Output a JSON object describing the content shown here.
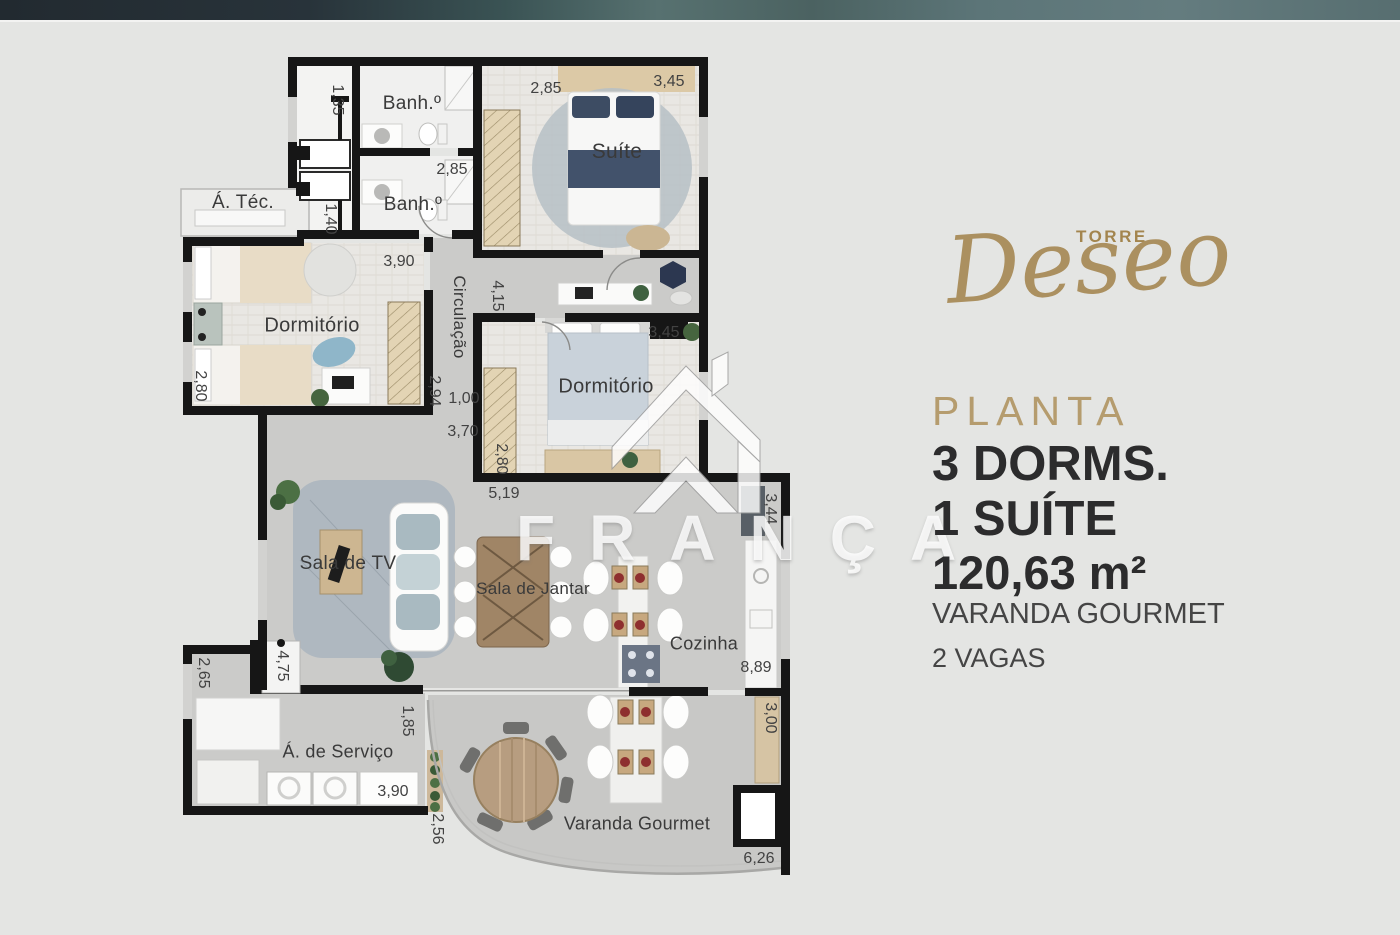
{
  "watermark": {
    "text": "FRANÇA",
    "logo": "house-arrow-icon"
  },
  "info": {
    "tower_label": "TORRE",
    "tower_name": "Deseo",
    "section_label": "PLANTA",
    "dorms": "3 DORMS.",
    "suite": "1 SUÍTE",
    "area": "120,63 m²",
    "feature_1": "VARANDA GOURMET",
    "feature_2": "2 VAGAS",
    "accent_color": "#a98e5c",
    "text_color": "#2c2c2d"
  },
  "plan": {
    "room_labels": [
      {
        "text": "Banh.º",
        "x": 412,
        "y": 104,
        "rot": false,
        "size": 19
      },
      {
        "text": "Suíte",
        "x": 617,
        "y": 152,
        "rot": false,
        "size": 21
      },
      {
        "text": "Banh.º",
        "x": 413,
        "y": 205,
        "rot": false,
        "size": 19
      },
      {
        "text": "Á. Téc.",
        "x": 243,
        "y": 203,
        "rot": false,
        "size": 19
      },
      {
        "text": "Circulação",
        "x": 459,
        "y": 317,
        "rot": true,
        "size": 17
      },
      {
        "text": "Dormitório",
        "x": 312,
        "y": 326,
        "rot": false,
        "size": 20
      },
      {
        "text": "Dormitório",
        "x": 606,
        "y": 387,
        "rot": false,
        "size": 20
      },
      {
        "text": "Sala de TV",
        "x": 348,
        "y": 564,
        "rot": false,
        "size": 19
      },
      {
        "text": "Sala de Jantar",
        "x": 533,
        "y": 589,
        "rot": false,
        "size": 17
      },
      {
        "text": "Cozinha",
        "x": 704,
        "y": 644,
        "rot": false,
        "size": 18
      },
      {
        "text": "Á. de Serviço",
        "x": 338,
        "y": 752,
        "rot": false,
        "size": 18
      },
      {
        "text": "Varanda Gourmet",
        "x": 637,
        "y": 824,
        "rot": false,
        "size": 18
      }
    ],
    "dim_labels": [
      {
        "text": "1,35",
        "x": 337,
        "y": 100,
        "rot": true
      },
      {
        "text": "2,85",
        "x": 546,
        "y": 89,
        "rot": false
      },
      {
        "text": "3,45",
        "x": 669,
        "y": 82,
        "rot": false
      },
      {
        "text": "2,85",
        "x": 452,
        "y": 170,
        "rot": false
      },
      {
        "text": "1,40",
        "x": 330,
        "y": 219,
        "rot": true
      },
      {
        "text": "3,90",
        "x": 399,
        "y": 262,
        "rot": false
      },
      {
        "text": "4,15",
        "x": 497,
        "y": 296,
        "rot": true
      },
      {
        "text": "3,45",
        "x": 664,
        "y": 333,
        "rot": false
      },
      {
        "text": "2,80",
        "x": 200,
        "y": 386,
        "rot": true
      },
      {
        "text": "2,94",
        "x": 434,
        "y": 391,
        "rot": true
      },
      {
        "text": "1,00",
        "x": 464,
        "y": 399,
        "rot": false
      },
      {
        "text": "3,70",
        "x": 463,
        "y": 432,
        "rot": false
      },
      {
        "text": "2,80",
        "x": 501,
        "y": 459,
        "rot": true
      },
      {
        "text": "5,19",
        "x": 504,
        "y": 494,
        "rot": false
      },
      {
        "text": "3,44",
        "x": 770,
        "y": 509,
        "rot": true
      },
      {
        "text": "8,89",
        "x": 756,
        "y": 668,
        "rot": false
      },
      {
        "text": "4,75",
        "x": 282,
        "y": 666,
        "rot": true
      },
      {
        "text": "2,65",
        "x": 203,
        "y": 673,
        "rot": true
      },
      {
        "text": "1,85",
        "x": 407,
        "y": 721,
        "rot": true
      },
      {
        "text": "3,00",
        "x": 770,
        "y": 718,
        "rot": true
      },
      {
        "text": "3,90",
        "x": 393,
        "y": 792,
        "rot": false
      },
      {
        "text": "2,56",
        "x": 437,
        "y": 829,
        "rot": true
      },
      {
        "text": "6,26",
        "x": 759,
        "y": 859,
        "rot": false
      }
    ]
  }
}
